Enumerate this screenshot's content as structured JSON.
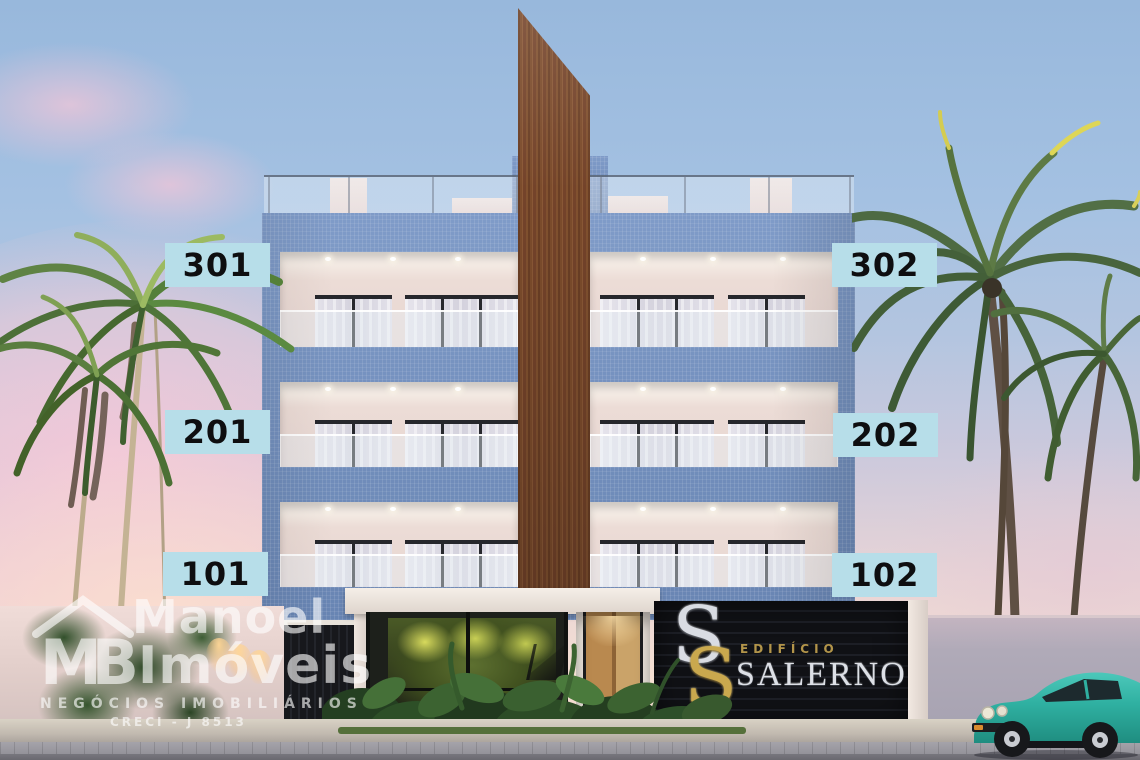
{
  "units": [
    {
      "label": "301"
    },
    {
      "label": "302"
    },
    {
      "label": "201"
    },
    {
      "label": "202"
    },
    {
      "label": "101"
    },
    {
      "label": "102"
    }
  ],
  "building_sign": {
    "monogram_s1": "S",
    "monogram_s2": "S",
    "line1": "EDIFÍCIO",
    "line2": "SALERNO"
  },
  "watermark": {
    "logo_initials": "MB",
    "name_line1": "Manoel",
    "name_line2": "Imóveis",
    "tagline": "NEGÓCIOS IMOBILIÁRIOS",
    "license": "CRECI - J 8513"
  },
  "colors": {
    "label_bg": "#b7dee9",
    "label_text": "#0e0e10",
    "tile_blue": "#7190c2",
    "wood_brown": "#7c4c2c",
    "sign_bg": "#101115",
    "sign_gold": "#c9a84e",
    "sign_silver": "#dde0e6",
    "car_teal": "#2fb0a1",
    "sky_blue": "#a4c1e2",
    "sky_pink": "#f6c8d8"
  }
}
